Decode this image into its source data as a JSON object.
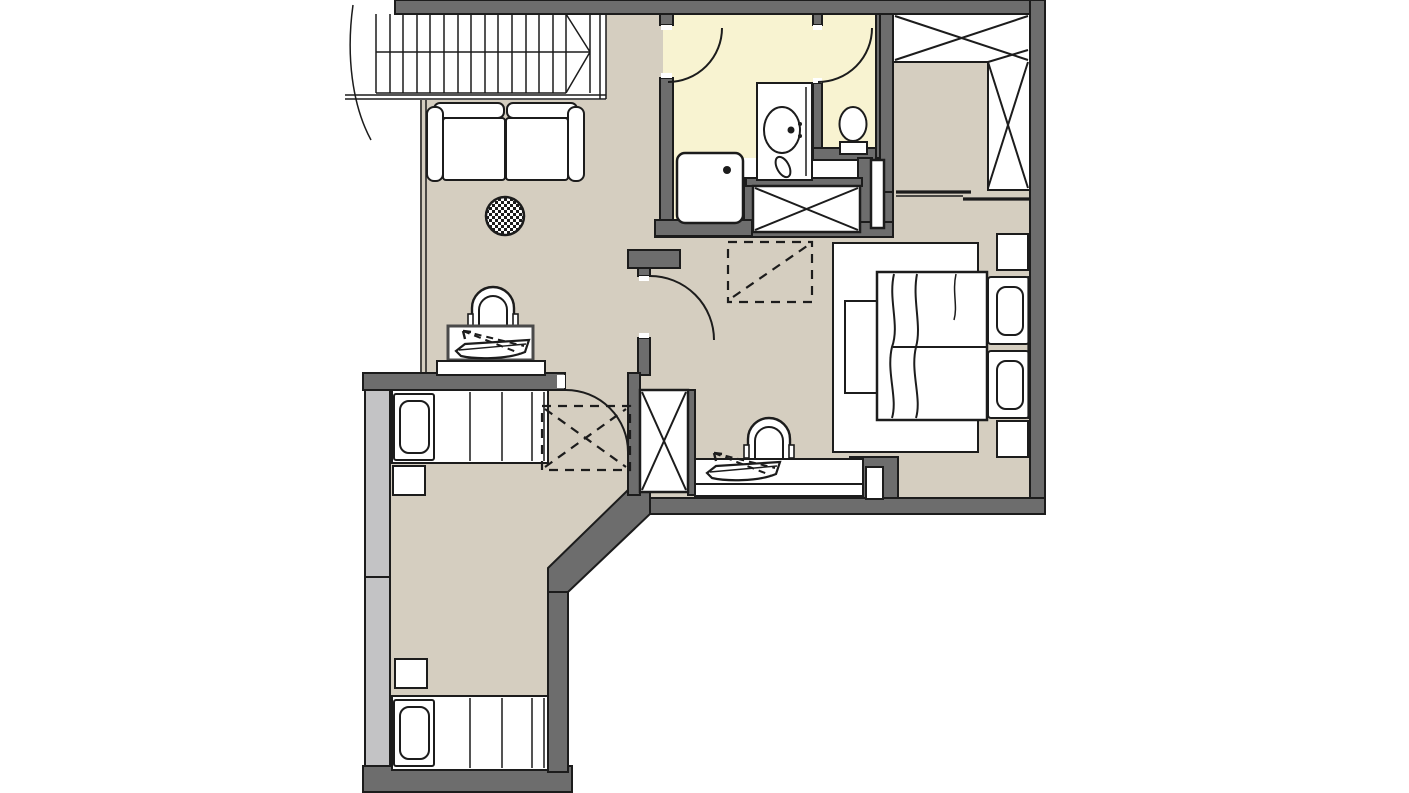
{
  "type": "floor-plan",
  "colors": {
    "background": "#ffffff",
    "floor": "#d5cec0",
    "bathroom_floor": "#f8f3d1",
    "wall": "#6d6d6d",
    "window_band": "#c3c3c5",
    "line": "#1c1c1c",
    "furniture_fill": "#ffffff"
  },
  "rooms": [
    {
      "id": "living-room",
      "label": "Living room"
    },
    {
      "id": "hallway",
      "label": "Hallway"
    },
    {
      "id": "shower-room",
      "label": "Shower room with washbasin"
    },
    {
      "id": "wc",
      "label": "WC"
    },
    {
      "id": "dressing-area",
      "label": "Dressing area with built-in wardrobe"
    },
    {
      "id": "bedroom",
      "label": "Bedroom"
    },
    {
      "id": "second-bedroom",
      "label": "Second bedroom with two single beds"
    }
  ],
  "elements": {
    "plan": "Apartment floor plan",
    "stairs": "Staircase",
    "sofa": "Two-seat sofa",
    "side_table": "Round side table",
    "chair": "Chair",
    "desk": "Desk",
    "sideboard": "Sideboard",
    "luggage_rack": "Fold-out luggage rack",
    "shower": "Shower tray",
    "vanity": "Washbasin vanity",
    "toilet": "Toilet",
    "shaft": "Installation shaft",
    "wardrobe": "Built-in wardrobe",
    "sliding_door": "Sliding door",
    "rug": "Rug",
    "double_bed": "Double bed",
    "pillow": "Pillow",
    "bench": "Bed bench",
    "nightstand": "Nightstand",
    "single_bed": "Single bed",
    "door": "Door swing",
    "window": "Window wall",
    "clearance": "Clearance zone",
    "entry_niche": "Wall niche"
  }
}
